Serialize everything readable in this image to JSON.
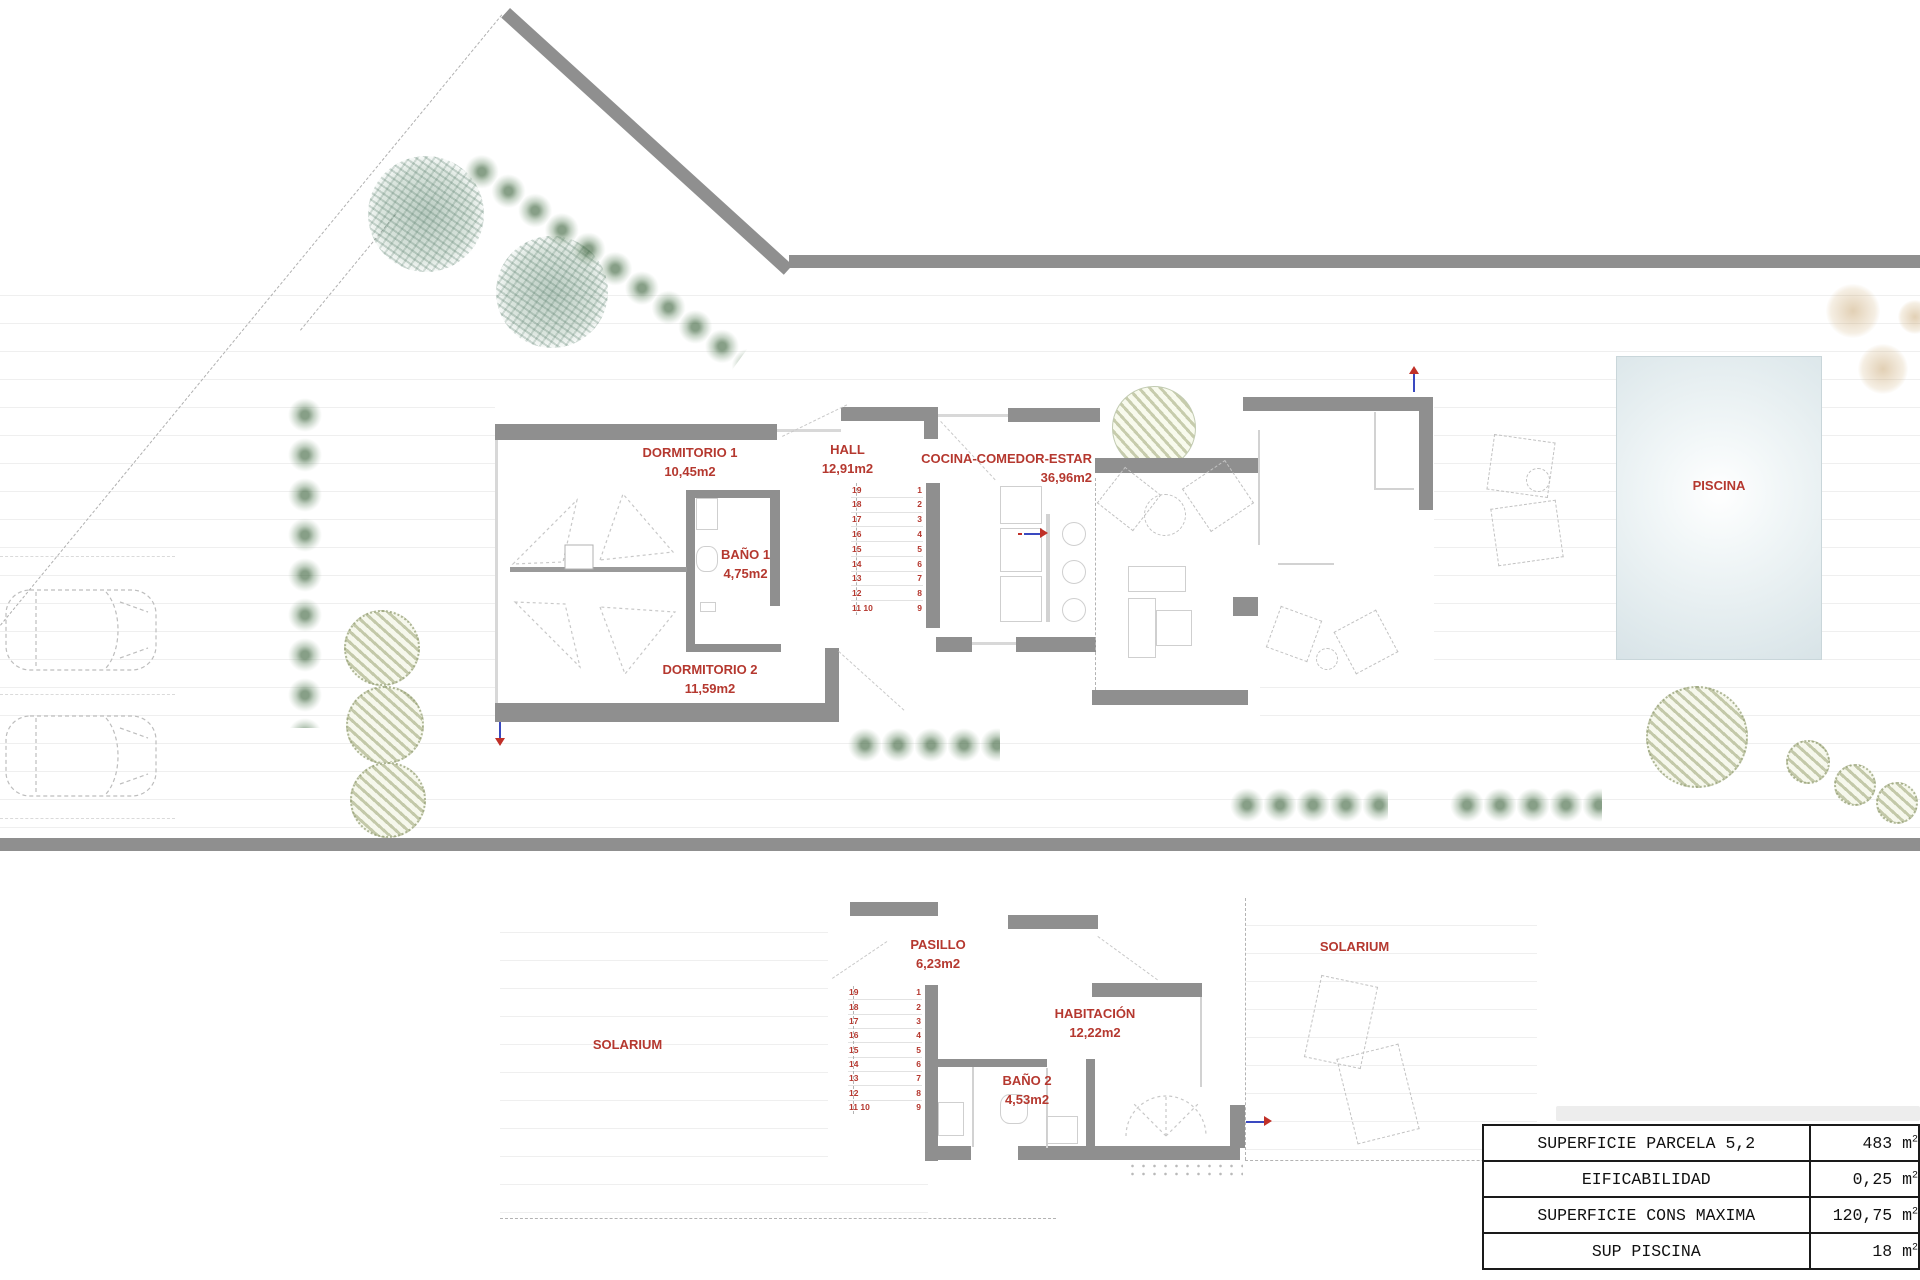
{
  "ground_floor": {
    "rooms": {
      "dormitorio1": {
        "name": "DORMITORIO 1",
        "area": "10,45m2"
      },
      "hall": {
        "name": "HALL",
        "area": "12,91m2"
      },
      "bano1": {
        "name": "BAÑO 1",
        "area": "4,75m2"
      },
      "dormitorio2": {
        "name": "DORMITORIO 2",
        "area": "11,59m2"
      },
      "cocina": {
        "name": "COCINA-COMEDOR-ESTAR",
        "area": "36,96m2"
      },
      "piscina": {
        "name": "PISCINA"
      }
    }
  },
  "first_floor": {
    "rooms": {
      "pasillo": {
        "name": "PASILLO",
        "area": "6,23m2"
      },
      "solarium_left": {
        "name": "SOLARIUM"
      },
      "solarium_right": {
        "name": "SOLARIUM"
      },
      "habitacion": {
        "name": "HABITACIÓN",
        "area": "12,22m2"
      },
      "bano2": {
        "name": "BAÑO 2",
        "area": "4,53m2"
      }
    }
  },
  "stairs": {
    "left": [
      "19",
      "18",
      "17",
      "16",
      "15",
      "14",
      "13",
      "12",
      "11 10"
    ],
    "right": [
      "1",
      "2",
      "3",
      "4",
      "5",
      "6",
      "7",
      "8",
      "9"
    ]
  },
  "summary_table": {
    "rows": [
      {
        "label": "SUPERFICIE PARCELA 5,2",
        "value": "483",
        "unit": "m",
        "unit_sup": "2"
      },
      {
        "label": "EIFICABILIDAD",
        "value": "0,25",
        "unit": "m",
        "unit_sup": "2"
      },
      {
        "label": "SUPERFICIE CONS MAXIMA",
        "value": "120,75",
        "unit": "m",
        "unit_sup": "2"
      },
      {
        "label": "SUP PISCINA",
        "value": "18",
        "unit": "m",
        "unit_sup": "2"
      }
    ]
  },
  "colors": {
    "wall_gray": "#8f8f8f",
    "label_red": "#b5382f",
    "pool_fill": "#dfe9ec",
    "arrow_blue": "#3a49c0",
    "arrow_red": "#c03028"
  }
}
